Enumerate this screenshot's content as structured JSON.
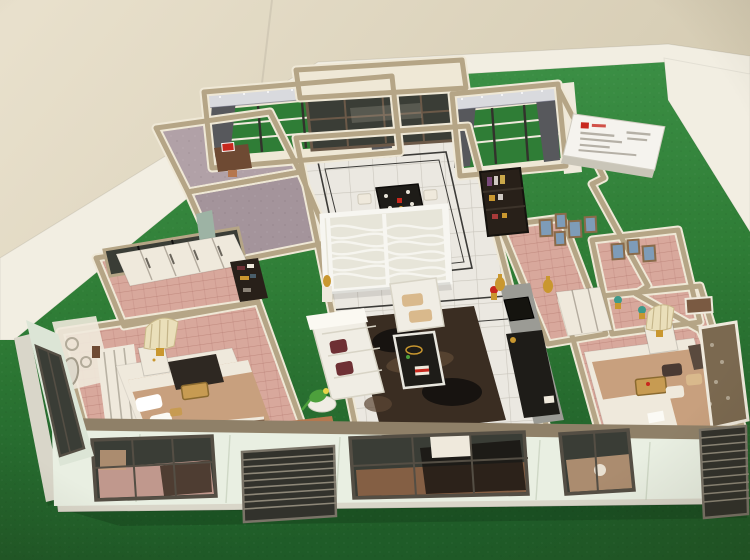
{
  "scene": {
    "subject": "architectural-scale-model",
    "sign_text_legible": false
  },
  "colors": {
    "bg-light": "#e9e1cd",
    "bg-dark": "#d0c6ac",
    "ledge": "#f2eee2",
    "turf": "#2f7d36",
    "turf-light": "#3f9449",
    "turf-dark": "#1f5c28",
    "base-edge": "#d9d6c9",
    "facade": "#e9efe2",
    "facade-shade": "#dce5d6",
    "wall-top": "#efe8d6",
    "wall-tan": "#b5a586",
    "wall-tan-dark": "#8f8068",
    "floor-wood": "#d8a89c",
    "wood-dark": "#c08e84",
    "floor-mauve": "#b1a1a7",
    "mauve-dark": "#a4949b",
    "floor-tile": "#ebe8e1",
    "tile-line": "#c9c5bc",
    "border-dark": "#3c3b38",
    "glass": "#3a3d36",
    "glass-frame": "#544e44",
    "frame-brown": "#6b5948",
    "rug": "#3a2d22",
    "rug-dark": "#171310",
    "rug-light": "#5c4734",
    "sofa": "#f0ede4",
    "pillow-maroon": "#6e3034",
    "cushion-tan": "#d9b98c",
    "table-black": "#1e1c18",
    "lattice": "#f7f6f1",
    "lattice-bg": "#e7e5d9",
    "valance": "#d9dade",
    "curtain": "#57585c",
    "bed-tan": "#c8a07e",
    "linen": "#efe9dc",
    "lamp-shade": "#eadfba",
    "gold": "#c9972f",
    "gold-deep": "#8a6a30",
    "shelf-dark": "#282019",
    "frame-blue": "#7e9cb8",
    "pic-frame": "#8a6b4a",
    "tv-wall": "#9b9b95",
    "plant": "#4da03c",
    "teal-door": "#9db3a4",
    "porch-brown": "#6e4a33",
    "deck": "#b5774e",
    "grille": "#32322c",
    "grille-slat": "#8d8778",
    "sign-white": "#f5f3ee",
    "sign-red": "#c8281e",
    "sign-line": "#b5b0a6"
  }
}
